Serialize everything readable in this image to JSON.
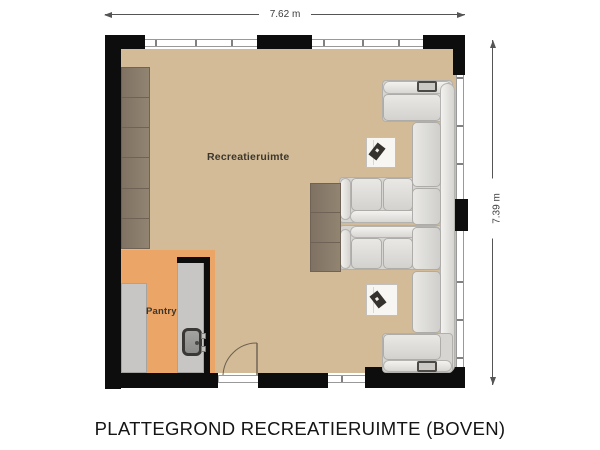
{
  "title": "PLATTEGROND RECREATIERUIMTE (BOVEN)",
  "dimensions": {
    "width_label": "7.62 m",
    "height_label": "7.39 m"
  },
  "rooms": {
    "main": {
      "label": "Recreatieruimte"
    },
    "pantry": {
      "label": "Pantry"
    }
  },
  "colors": {
    "wall": "#0d0d0d",
    "floor-main": "#d2bb96",
    "floor-pantry": "#eba566",
    "cabinet": "#8b7e6d",
    "cabinet-border": "#6e6356",
    "sofa": "#d6d5d2",
    "sofa-edge": "#b2b0ac",
    "counter": "#c7c6c4",
    "counter-border": "#a5a4a1",
    "table": "#f7f6f3",
    "magazine": "#35322d",
    "window-line": "#999999",
    "dim-line": "#555555",
    "text": "#141414",
    "label-text": "#3c362c"
  }
}
